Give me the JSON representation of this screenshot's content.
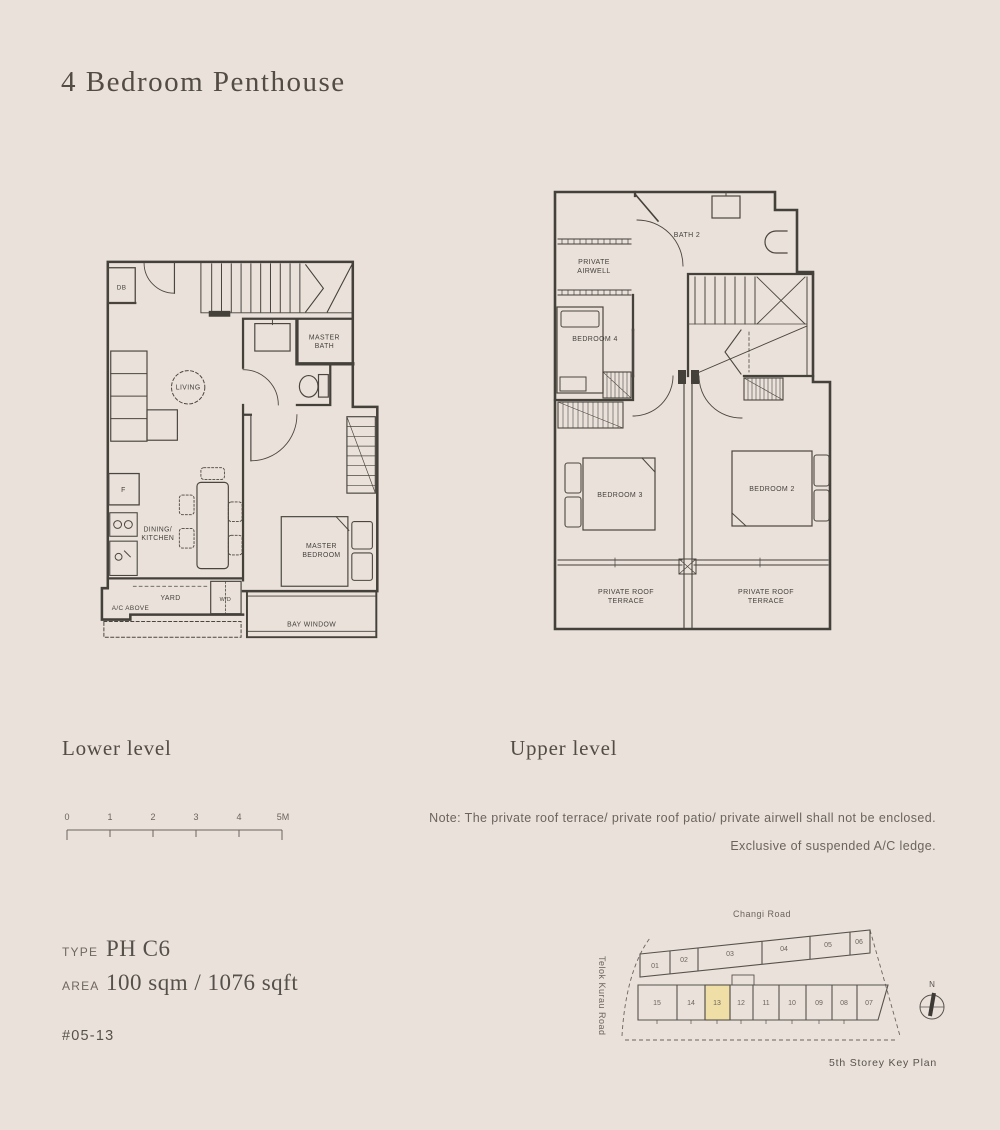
{
  "page": {
    "title": "4 Bedroom Penthouse"
  },
  "plans": {
    "lower": {
      "caption": "Lower level",
      "labels": {
        "db": "DB",
        "living": "LIVING",
        "master_bath": [
          "MASTER",
          "BATH"
        ],
        "fridge": "F",
        "dining_kitchen": [
          "DINING/",
          "KITCHEN"
        ],
        "yard": "YARD",
        "washer_dryer": "W/D",
        "ac_above": "A/C ABOVE",
        "master_bedroom": [
          "MASTER",
          "BEDROOM"
        ],
        "bay_window": "BAY WINDOW"
      }
    },
    "upper": {
      "caption": "Upper level",
      "labels": {
        "private_airwell": [
          "PRIVATE",
          "AIRWELL"
        ],
        "bath2": "BATH 2",
        "bedroom4": "BEDROOM 4",
        "bedroom3": "BEDROOM 3",
        "bedroom2": "BEDROOM 2",
        "terrace_left": [
          "PRIVATE ROOF",
          "TERRACE"
        ],
        "terrace_right": [
          "PRIVATE ROOF",
          "TERRACE"
        ]
      }
    }
  },
  "scale_bar": {
    "ticks": [
      "0",
      "1",
      "2",
      "3",
      "4",
      "5M"
    ]
  },
  "note": {
    "line1": "Note: The private roof terrace/ private roof patio/ private airwell shall not be enclosed.",
    "line2": "Exclusive of suspended A/C ledge."
  },
  "details": {
    "type_label": "TYPE",
    "type_value": "PH C6",
    "area_label": "AREA",
    "area_value": "100 sqm / 1076 sqft",
    "unit_number": "#05-13"
  },
  "key_plan": {
    "road_top": "Changi Road",
    "road_left": "Telok Kurau Road",
    "title": "5th Storey Key Plan",
    "compass_north": "N",
    "top_units": [
      "01",
      "02",
      "03",
      "04",
      "05",
      "06"
    ],
    "bottom_units": [
      "15",
      "14",
      "13",
      "12",
      "11",
      "10",
      "09",
      "08",
      "07"
    ],
    "highlighted_unit": "13",
    "highlight_color": "#EFDFA6"
  },
  "colors": {
    "background": "#EAE1DB",
    "line": "#44403A",
    "text": "#524C45",
    "muted": "#6B645D"
  }
}
